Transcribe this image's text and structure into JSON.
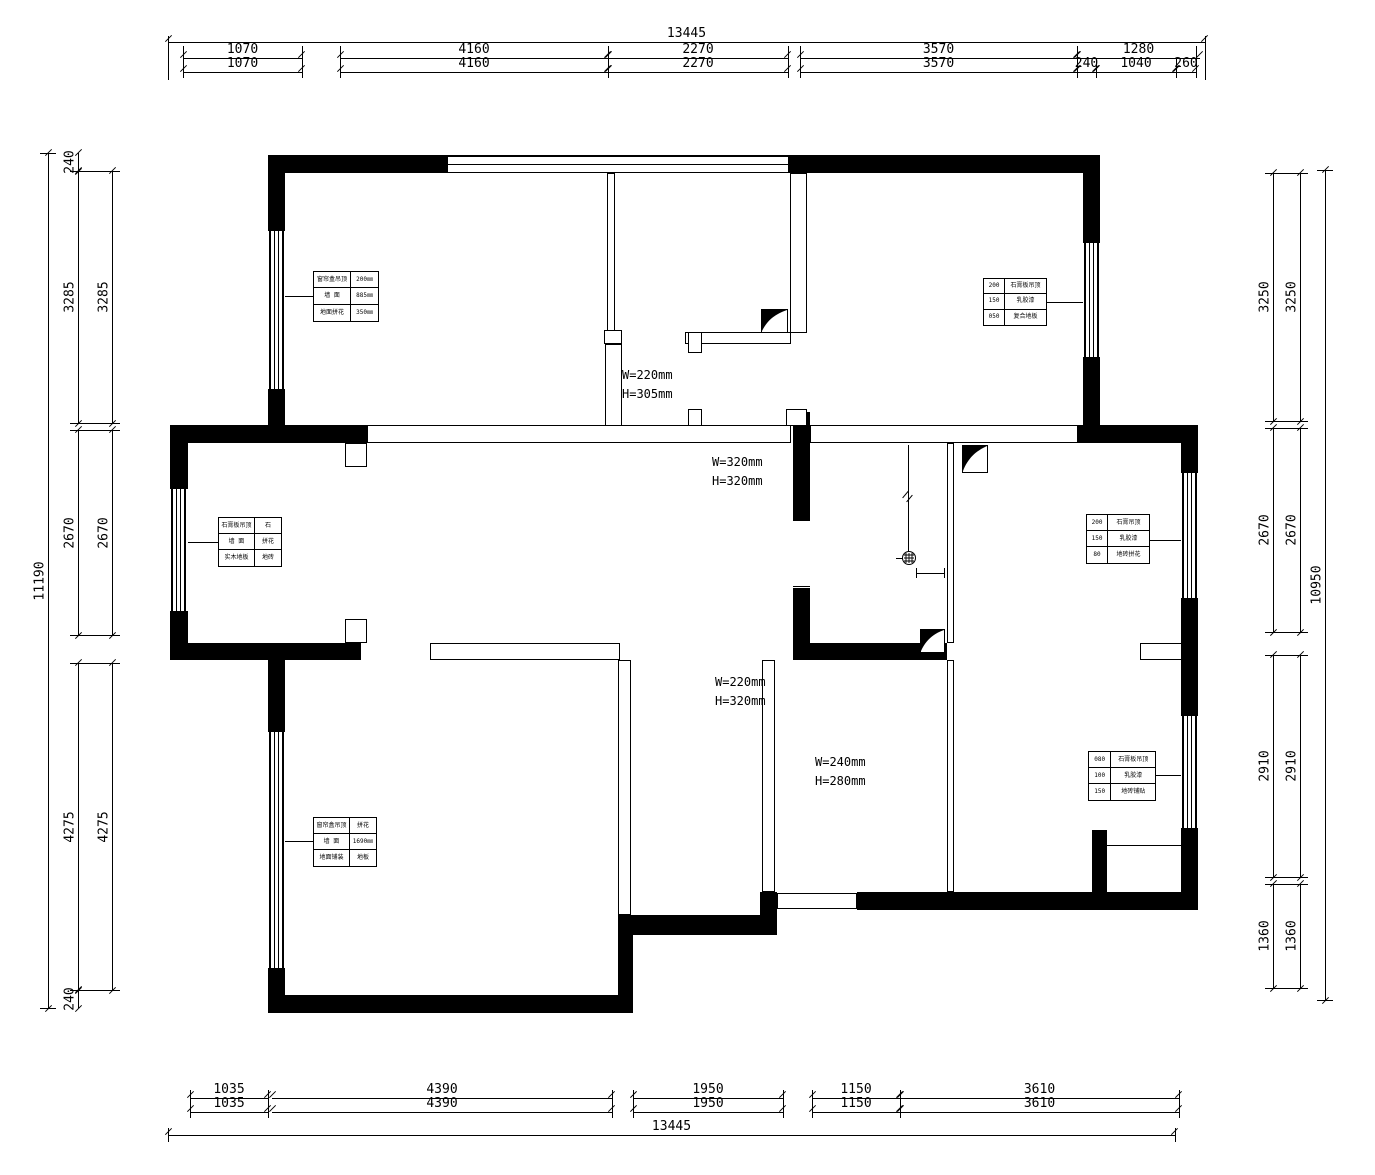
{
  "drawing": {
    "type": "residential floor plan",
    "units": "mm"
  },
  "colors": {
    "line": "#000000",
    "background": "#ffffff"
  },
  "icons": {
    "flue": "flue-shaft-icon",
    "drain": "floor-drain-icon"
  },
  "dims": {
    "top": {
      "overall": "13445",
      "row1": [
        "1070",
        "4160",
        "2270",
        "3570",
        "1280"
      ],
      "row2": [
        "1070",
        "4160",
        "2270",
        "3570",
        "240",
        "1040",
        "260"
      ]
    },
    "bottom": {
      "overall": "13445",
      "row": [
        "1035",
        "4390",
        "1950",
        "1150",
        "3610"
      ]
    },
    "left": {
      "overall": "11190",
      "chain": [
        "240",
        "3285",
        "2670",
        "4275",
        "240"
      ]
    },
    "right": {
      "overall": "10950",
      "chain": [
        "3250",
        "2670",
        "2910",
        "1360"
      ]
    }
  },
  "annotations": {
    "a1": {
      "line1": "W=220mm",
      "line2": "H=305mm"
    },
    "a2": {
      "line1": "W=320mm",
      "line2": "H=320mm"
    },
    "a3": {
      "line1": "W=220mm",
      "line2": "H=320mm"
    },
    "a4": {
      "line1": "W=240mm",
      "line2": "H=280mm"
    }
  },
  "spec_tables": {
    "t1": {
      "r": [
        [
          "窗帘盒吊顶",
          "200㎜"
        ],
        [
          "墙  面",
          "885㎜"
        ],
        [
          "地面拼花",
          "350㎜"
        ]
      ]
    },
    "t2": {
      "r": [
        [
          "200",
          "石膏板吊顶"
        ],
        [
          "150",
          "乳胶漆"
        ],
        [
          "050",
          "复合地板"
        ]
      ]
    },
    "t3": {
      "r": [
        [
          "石膏板吊顶",
          "石"
        ],
        [
          "墙  面",
          "拼花"
        ],
        [
          "实木地板",
          "地砖"
        ]
      ]
    },
    "t4": {
      "r": [
        [
          "200",
          "石膏吊顶"
        ],
        [
          "150",
          "乳胶漆"
        ],
        [
          "80",
          "地砖拼花"
        ]
      ]
    },
    "t5": {
      "r": [
        [
          "080",
          "石膏板吊顶"
        ],
        [
          "100",
          "乳胶漆"
        ],
        [
          "150",
          "地砖铺贴"
        ]
      ]
    },
    "t6": {
      "r": [
        [
          "窗帘盒吊顶",
          "拼花"
        ],
        [
          "墙  面",
          "1690㎜"
        ],
        [
          "地面铺装",
          "地板"
        ]
      ]
    }
  }
}
